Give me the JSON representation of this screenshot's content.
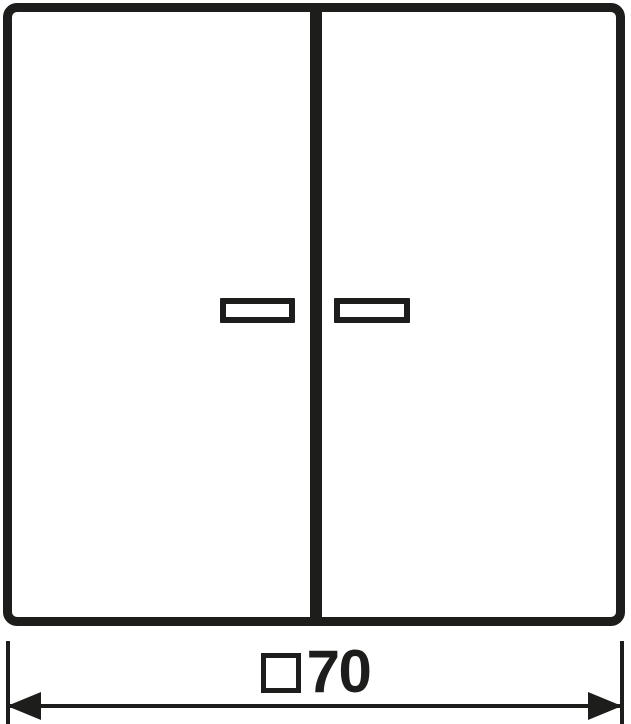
{
  "colors": {
    "line": "#1d1d1b",
    "background": "#ffffff"
  },
  "drawing": {
    "kind": "dimension-drawing",
    "subject": "two-gang-rocker-plate-with-lens-windows",
    "dimension": {
      "symbol": "□",
      "value": "70",
      "text": "□70"
    }
  }
}
